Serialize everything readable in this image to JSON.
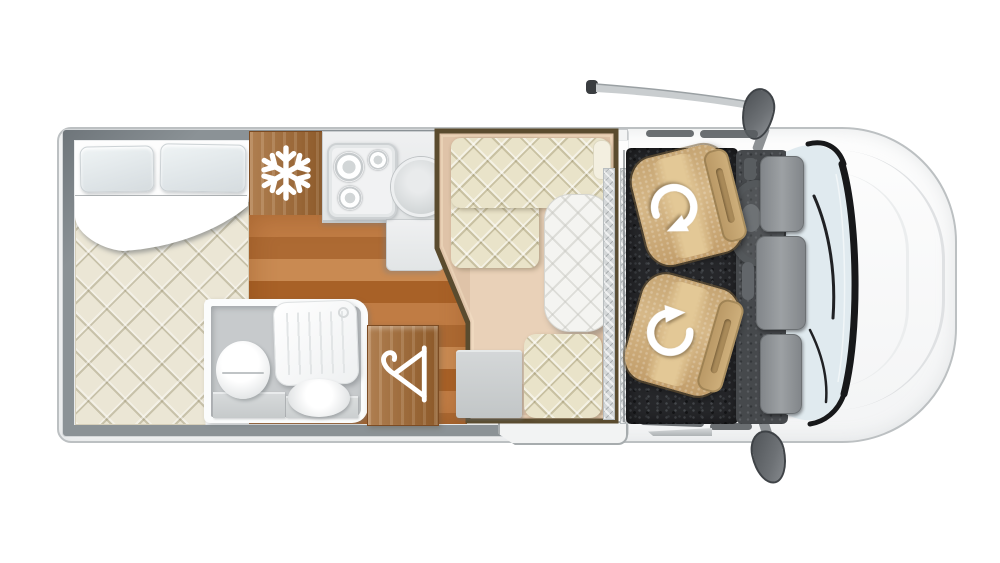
{
  "scene": {
    "description": "Top-down floor plan illustration of a van-based motorhome, front of vehicle facing right",
    "text_visible": "none"
  },
  "zones": {
    "bed": "Rear double bed with two pillows, folded sheet and quilted mattress",
    "fridge": "Refrigerator wood cabinet marked with snowflake symbol",
    "kitchen": "Kitchen block with three-burner hob and round sink",
    "kitchen_floor": "Wooden kitchen floor",
    "bathroom": "Bathroom with toilet, shower tray and washbasin",
    "wardrobe": "Wood wardrobe marked with clothes-hanger symbol",
    "dinette": "Lounge area outlined in dark trim with L-shaped quilted sofa, table and single seat",
    "entry_step": "Entrance step strip with tread texture",
    "cab": "Driver cab with two swivel captain seats on dark carpet",
    "dashboard": "Dashboard with steering wheel and centre console",
    "windshield": "Windscreen with black trim and wipers",
    "mirror_top": "Upper side mirror",
    "mirror_bottom": "Lower side mirror"
  },
  "icons": {
    "fridge": "snowflake-icon",
    "wardrobe": "hanger-icon",
    "cab_seats": "swivel-arrow-icon"
  },
  "counts": {
    "pillows": 2,
    "hob_burners": 3,
    "cab_seats": 2,
    "dinette_seats": 2
  },
  "palette": {
    "body": "#f7f8f8",
    "wall_gray": "#8b9296",
    "mattress": "#ebe6d5",
    "sofa": "#e9e3c9",
    "dinette_floor": "#dfc3a8",
    "dinette_border": "#5a4b2e",
    "furniture_wood": "#a0662f",
    "floor_wood": "#b97038",
    "counter": "#e9ebec",
    "bath_floor": "#c7cacc",
    "carpet": "#26272a",
    "cab_seat": "#cfae7e",
    "windshield": "#e0eaef",
    "icon_white": "#ffffff"
  }
}
